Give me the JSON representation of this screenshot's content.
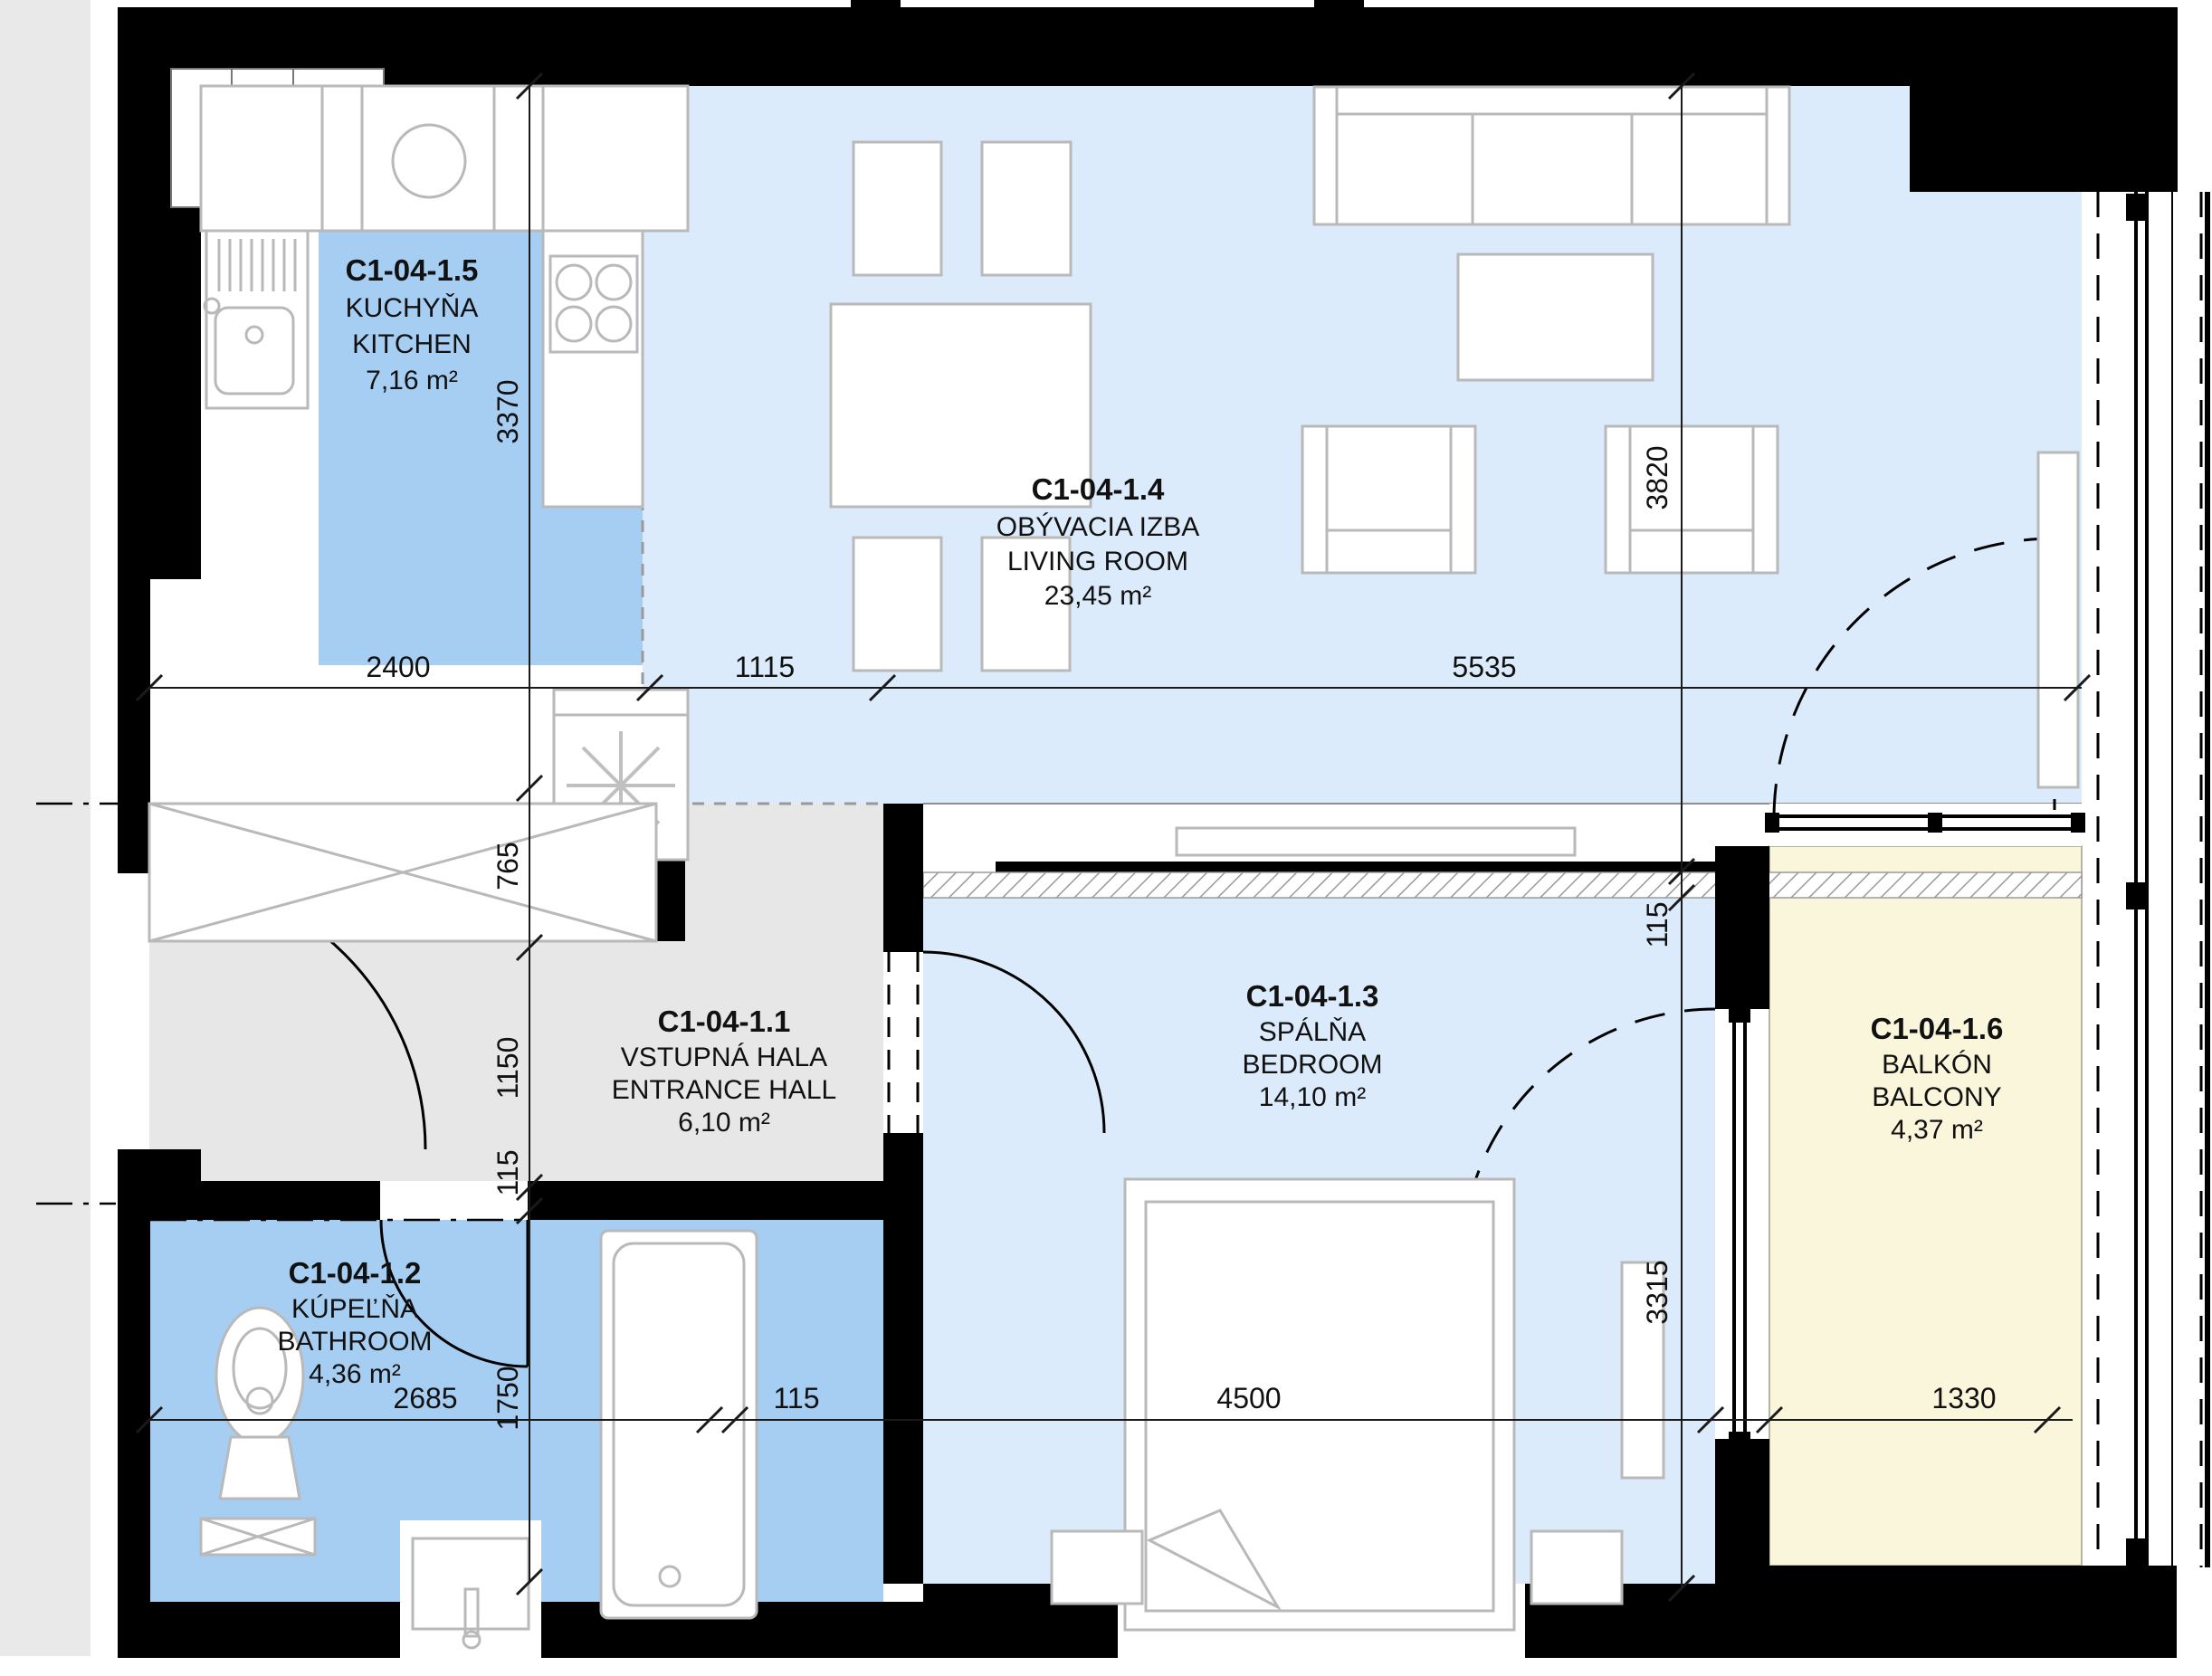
{
  "plan": {
    "title": "Apartment C1-04 floor plan",
    "rooms": [
      {
        "code": "C1-04-1.5",
        "name_local": "KUCHYŇA",
        "name_en": "KITCHEN",
        "area": "7,16 m²"
      },
      {
        "code": "C1-04-1.4",
        "name_local": "OBÝVACIA IZBA",
        "name_en": "LIVING ROOM",
        "area": "23,45 m²"
      },
      {
        "code": "C1-04-1.1",
        "name_local": "VSTUPNÁ HALA",
        "name_en": "ENTRANCE HALL",
        "area": "6,10 m²"
      },
      {
        "code": "C1-04-1.3",
        "name_local": "SPÁLŇA",
        "name_en": "BEDROOM",
        "area": "14,10 m²"
      },
      {
        "code": "C1-04-1.2",
        "name_local": "KÚPEĽŇA",
        "name_en": "BATHROOM",
        "area": "4,36 m²"
      },
      {
        "code": "C1-04-1.6",
        "name_local": "BALKÓN",
        "name_en": "BALCONY",
        "area": "4,37 m²"
      }
    ],
    "dimensions": {
      "left_3370": "3370",
      "left_765": "765",
      "left_1150": "1150",
      "left_115": "115",
      "left_1750": "1750",
      "top_2400": "2400",
      "top_1115": "1115",
      "top_5535": "5535",
      "right_3820": "3820",
      "right_115": "115",
      "right_3315": "3315",
      "bottom_2685": "2685",
      "bottom_115": "115",
      "bottom_4500": "4500",
      "bottom_1330": "1330"
    },
    "colors": {
      "room-strong-blue": "#a6cdf2",
      "room-light-blue": "#dcebfb",
      "room-gray": "#e7e7e7",
      "room-cream": "#f9f6db",
      "wall": "#000000",
      "furniture-line": "#b9b9b9",
      "dim-line": "#1a1a1a"
    }
  }
}
